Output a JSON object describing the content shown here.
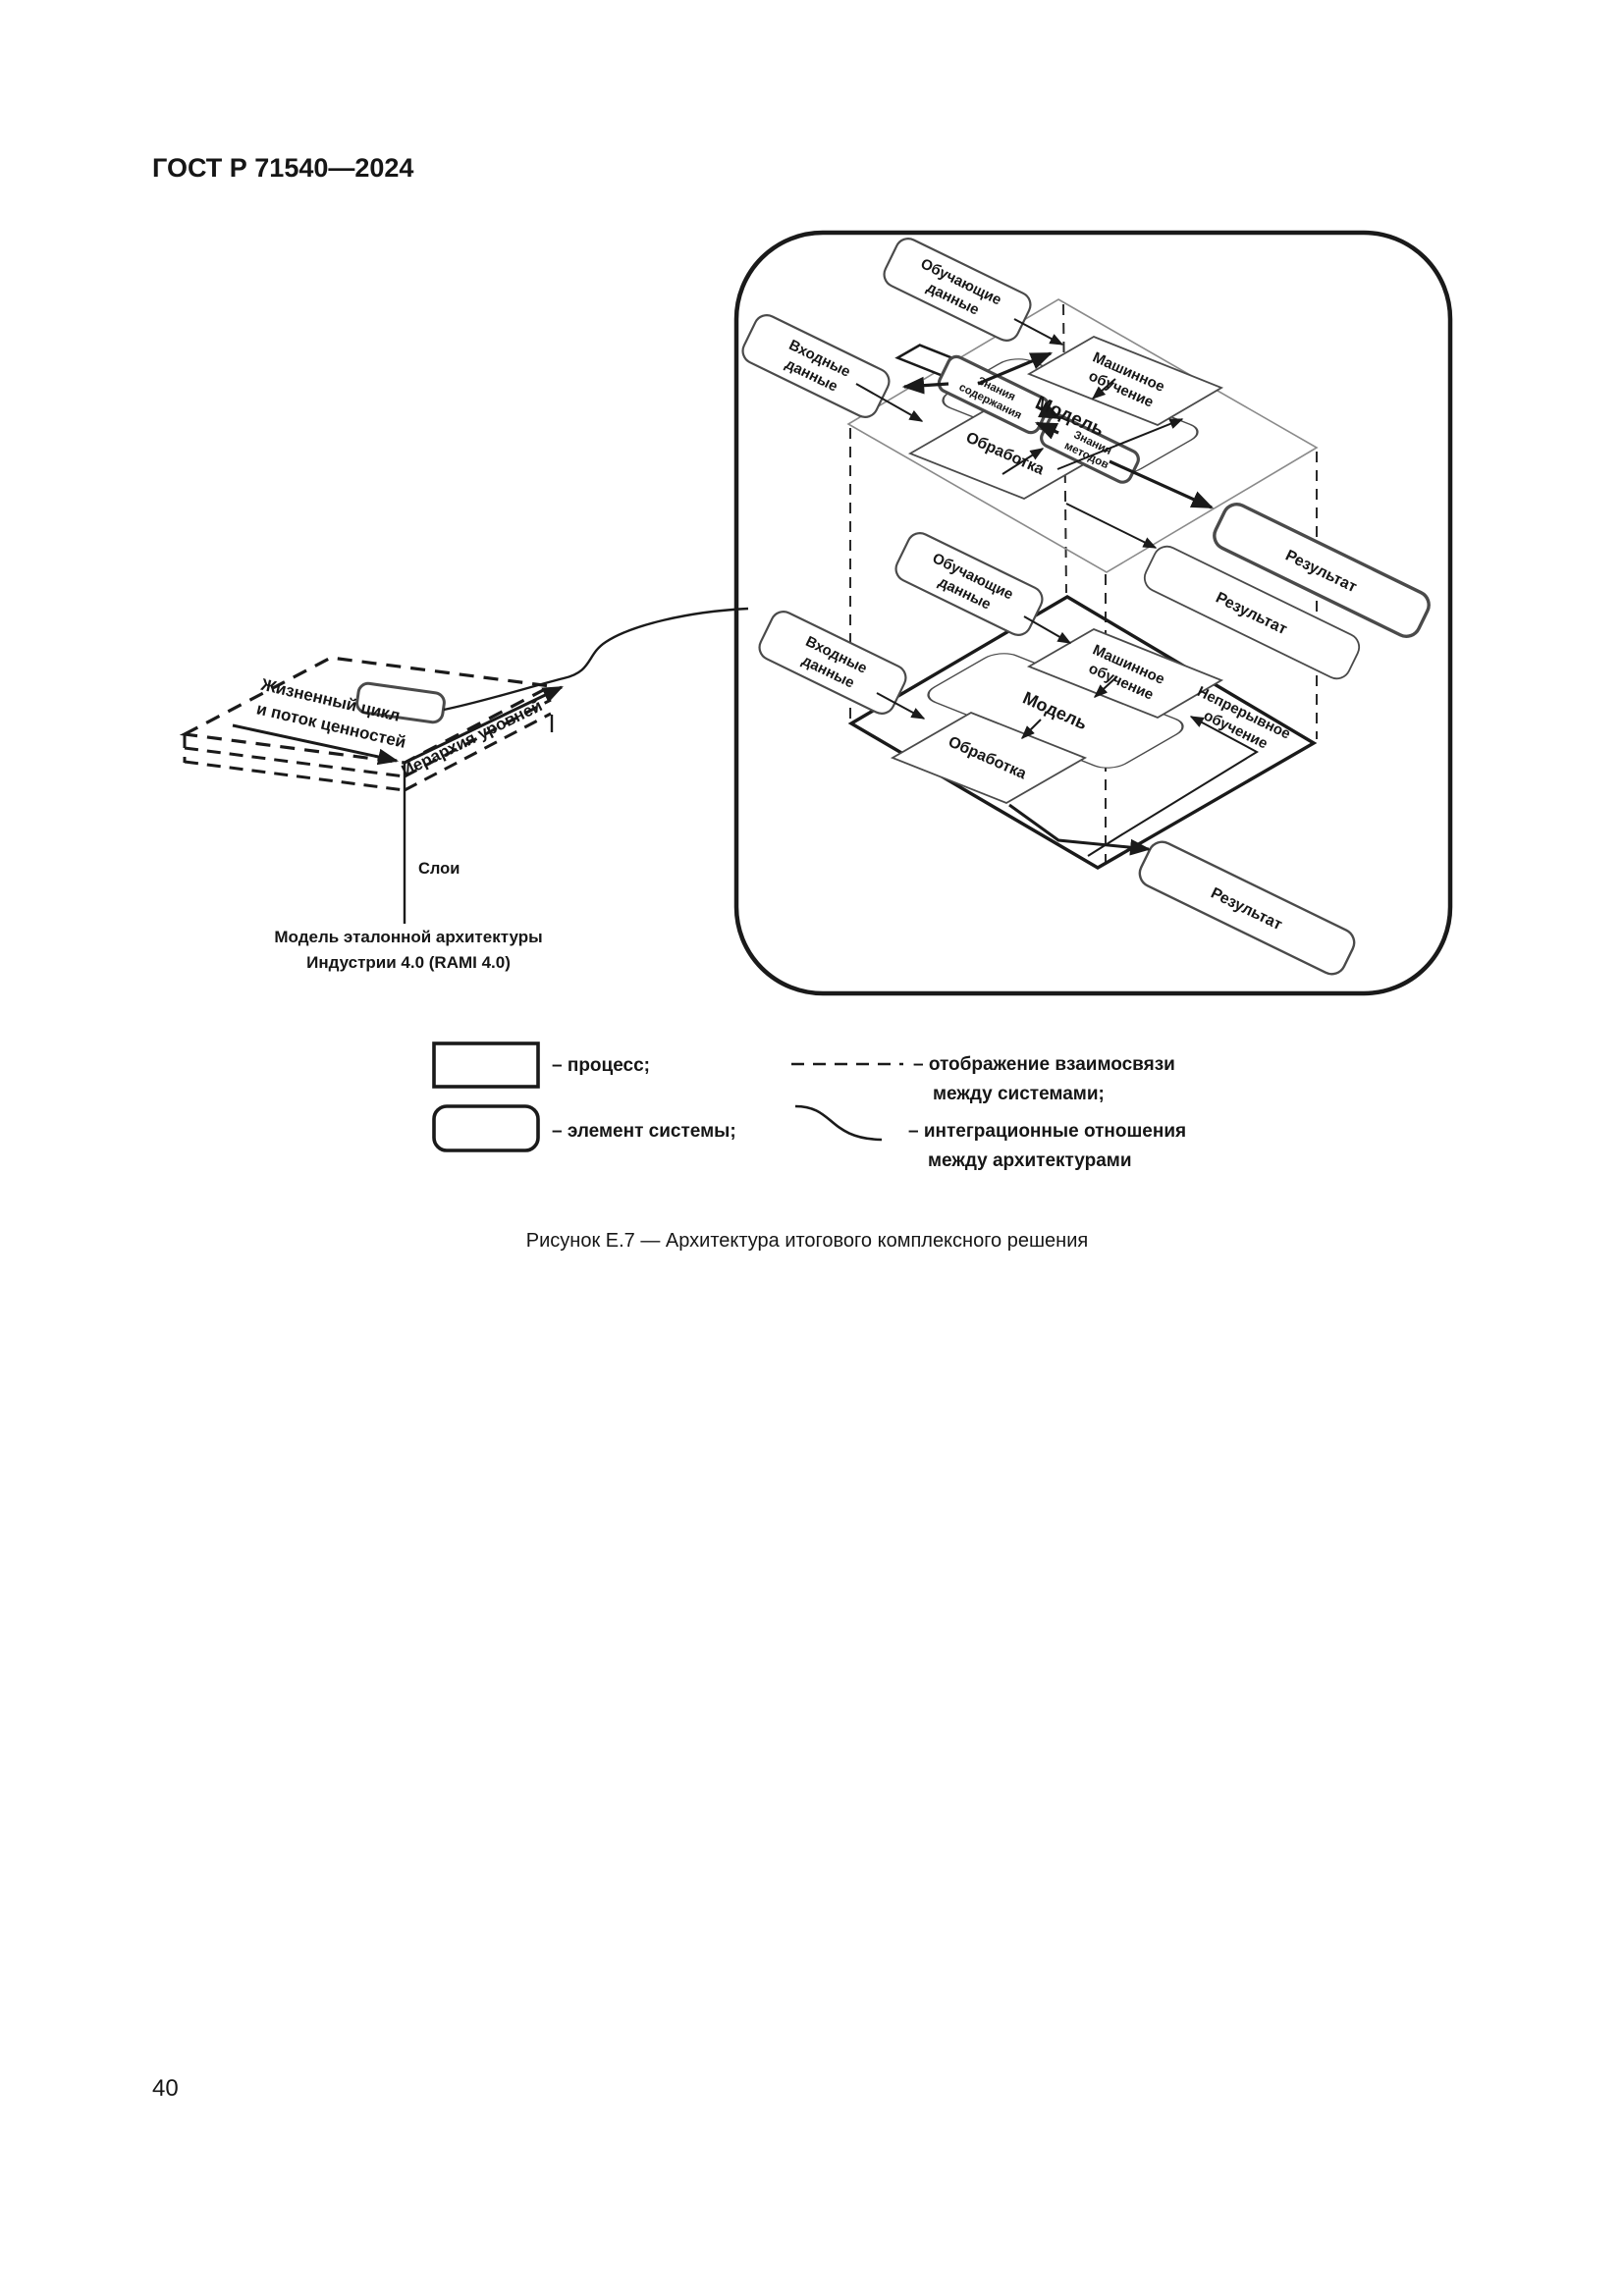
{
  "page": {
    "header": "ГОСТ Р 71540—2024",
    "caption": "Рисунок Е.7 — Архитектура итогового комплексного решения",
    "number": "40"
  },
  "labels": {
    "training1": "Обучающие",
    "training2": "данные",
    "input1": "Входные",
    "input2": "данные",
    "ml1": "Машинное",
    "ml2": "обучение",
    "model": "Модель",
    "know_content1": "Знания",
    "know_content2": "содержания",
    "know_methods1": "Знания",
    "know_methods2": "методов",
    "processing": "Обработка",
    "result": "Результат",
    "continuous1": "Непрерывное",
    "continuous2": "обучение"
  },
  "rami": {
    "lifecycle1": "Жизненный цикл",
    "lifecycle2": "и поток ценностей",
    "hierarchy": "Иерархия уровней",
    "layers": "Слои",
    "caption1": "Модель эталонной архитектуры",
    "caption2": "Индустрии 4.0 (RAMI 4.0)"
  },
  "legend": {
    "process": "– процесс;",
    "element": "– элемент системы;",
    "mapping1": "– отображение взаимосвязи",
    "mapping2": "между системами;",
    "integration1": "– интеграционные отношения",
    "integration2": "между архитектурами"
  },
  "colors": {
    "ink": "#1a1a1a",
    "plane": "#8a8a8a",
    "background": "#ffffff"
  }
}
